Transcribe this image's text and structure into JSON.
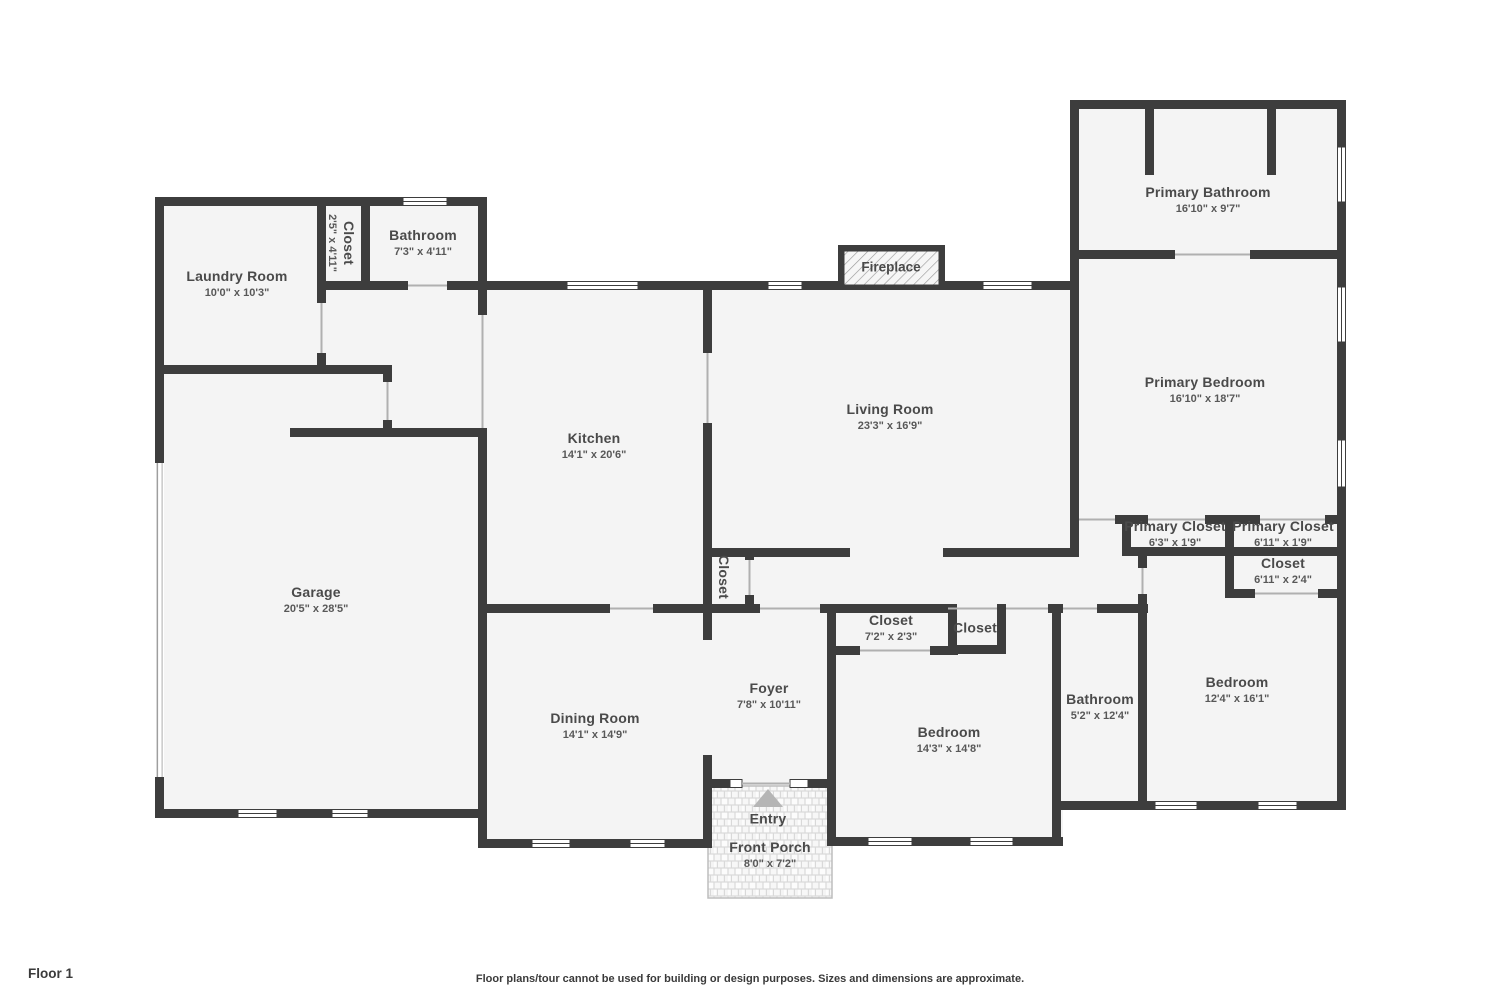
{
  "page": {
    "floor_label": "Floor 1",
    "disclaimer": "Floor plans/tour cannot be used for building or design purposes. Sizes and dimensions are approximate."
  },
  "colors": {
    "wall": "#3d3d3d",
    "room_fill": "#f4f4f4",
    "label_text": "#4a4a4a",
    "dims_text": "#585858",
    "door_line": "#b0b0b0",
    "porch_tile_line": "#d2d2d2",
    "entry_arrow": "#b5b5b5"
  },
  "features": {
    "fireplace_label": "Fireplace",
    "entry_label": "Entry"
  },
  "rooms": [
    {
      "name": "Laundry Room",
      "dims": "10'0\" x 10'3\""
    },
    {
      "name": "Closet",
      "dims": "2'5\" x 4'11\""
    },
    {
      "name": "Bathroom",
      "dims": "7'3\" x 4'11\""
    },
    {
      "name": "Primary Bathroom",
      "dims": "16'10\" x 9'7\""
    },
    {
      "name": "Living Room",
      "dims": "23'3\" x 16'9\""
    },
    {
      "name": "Kitchen",
      "dims": "14'1\" x 20'6\""
    },
    {
      "name": "Primary Bedroom",
      "dims": "16'10\" x 18'7\""
    },
    {
      "name": "Garage",
      "dims": "20'5\" x 28'5\""
    },
    {
      "name": "Primary Closet",
      "dims": "6'3\" x 1'9\""
    },
    {
      "name": "Primary Closet",
      "dims": "6'11\" x 1'9\""
    },
    {
      "name": "Closet",
      "dims": "6'11\" x 2'4\""
    },
    {
      "name": "Closet",
      "dims": ""
    },
    {
      "name": "Closet",
      "dims": "7'2\" x 2'3\""
    },
    {
      "name": "Closet",
      "dims": ""
    },
    {
      "name": "Foyer",
      "dims": "7'8\" x 10'11\""
    },
    {
      "name": "Dining Room",
      "dims": "14'1\" x 14'9\""
    },
    {
      "name": "Bedroom",
      "dims": "14'3\" x 14'8\""
    },
    {
      "name": "Bathroom",
      "dims": "5'2\" x 12'4\""
    },
    {
      "name": "Bedroom",
      "dims": "12'4\" x 16'1\""
    },
    {
      "name": "Front Porch",
      "dims": "8'0\" x 7'2\""
    }
  ]
}
